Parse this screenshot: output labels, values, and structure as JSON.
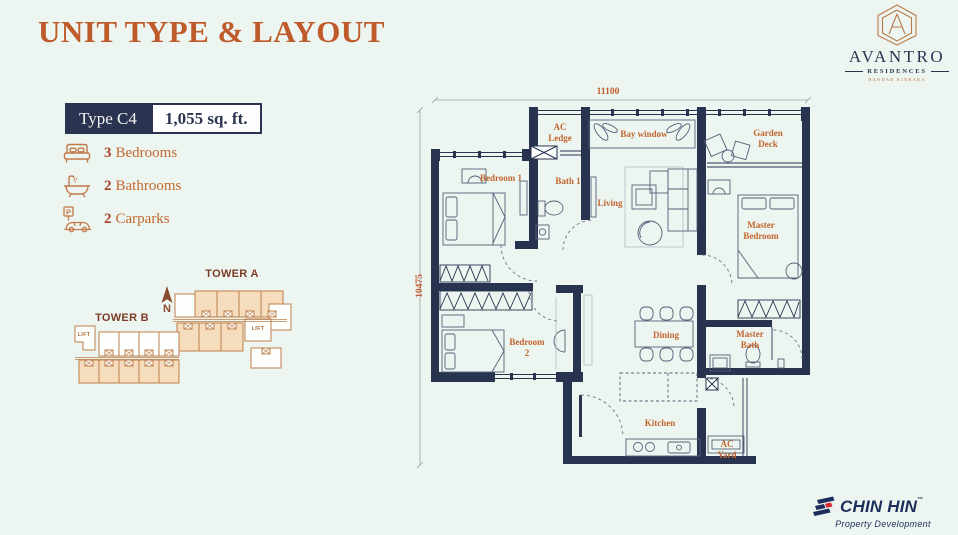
{
  "page": {
    "title": "UNIT TYPE & LAYOUT"
  },
  "brand": {
    "name": "AVANTRO",
    "residences": "RESIDENCES",
    "tagline": "BANDAR KINRARA"
  },
  "unit": {
    "type_label": "Type C4",
    "area": "1,055 sq. ft."
  },
  "features": [
    {
      "icon": "bed-icon",
      "count": "3",
      "label": "Bedrooms"
    },
    {
      "icon": "bath-icon",
      "count": "2",
      "label": "Bathrooms"
    },
    {
      "icon": "car-icon",
      "count": "2",
      "label": "Carparks"
    }
  ],
  "icons": {
    "parking_letter": "P"
  },
  "towers": {
    "tower_a": "TOWER A",
    "tower_b": "TOWER B",
    "lift": "LIFT",
    "north": "N"
  },
  "floorplan": {
    "dim_width": "11100",
    "dim_height": "10475",
    "rooms": {
      "ac_ledge": "AC\nLedge",
      "bay_window": "Bay window",
      "garden_deck": "Garden\nDeck",
      "bedroom1": "Bedroom 1",
      "bath1": "Bath 1",
      "living": "Living",
      "master_bedroom": "Master\nBedroom",
      "bedroom2": "Bedroom\n2",
      "dining": "Dining",
      "master_bath": "Master\nBath",
      "kitchen": "Kitchen",
      "ac_yard": "AC\nYard"
    }
  },
  "footer": {
    "developer": "CHIN HIN",
    "tm": "™",
    "tagline": "Property Development"
  },
  "colors": {
    "accent": "#bf5b2b",
    "navy": "#27334f",
    "tower_line": "#bf7f4a",
    "tower_fill": "#f6ddbd",
    "logo_red": "#d9252d"
  }
}
